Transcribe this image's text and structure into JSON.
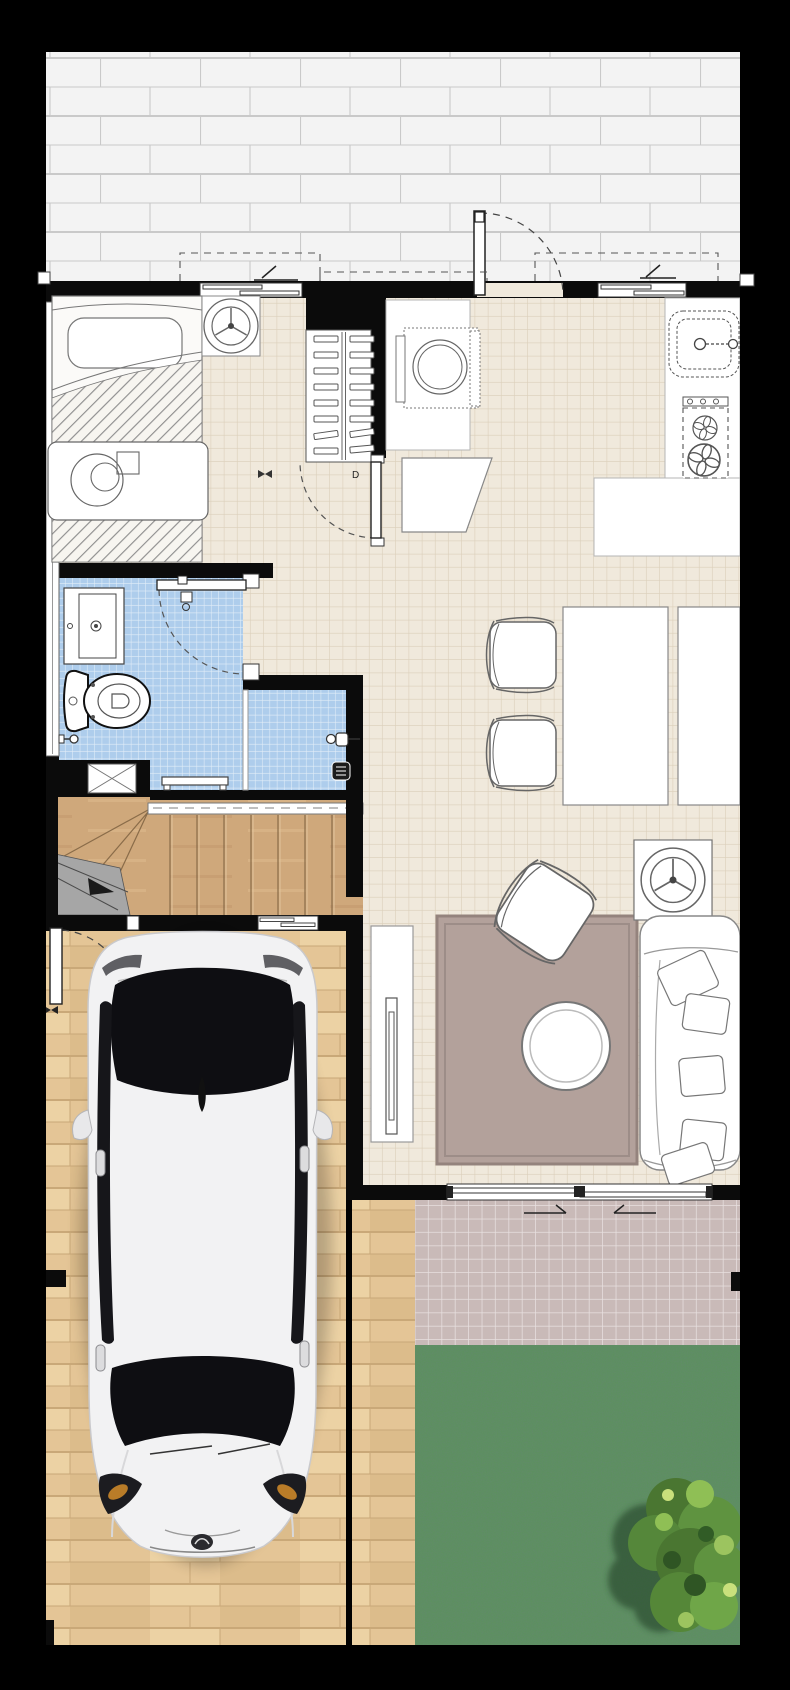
{
  "meta": {
    "image_type": "architectural floor plan, top-down 2D render, ground floor of a narrow townhouse",
    "canvas_px": "790x1690",
    "orientation": "street/patio at top, garden at bottom"
  },
  "labels": {
    "door_marker": "D"
  },
  "palette": {
    "background": "#000000",
    "wall": "#0b0b0b",
    "patio_brick": "#f3f3f3",
    "brick_line": "#c9c9c9",
    "interior_tile": "#f0e9dc",
    "interior_tile_line": "#dbcfba",
    "bathroom_tile": "#aecdec",
    "stair_wood": "#cfa87b",
    "garage_wood": "#e4c596",
    "landing_gray": "#a6a6a6",
    "rug": "#b3a19b",
    "terrace_tile": "#c9bab8",
    "lawn": "#5d9060",
    "tree_dark": "#3f6b2f",
    "tree_mid": "#5f9340",
    "tree_light": "#8fbf55",
    "car_body": "#f2f2f3",
    "car_glass": "#121216",
    "fixture_white": "#ffffff",
    "outline": "#555555"
  },
  "rooms": [
    {
      "name": "front-patio",
      "floor": "gray brick pavers, running bond"
    },
    {
      "name": "bedroom",
      "floor": "beige ceramic tile",
      "furniture": [
        "single bed with hatched blanket",
        "pillow",
        "headboard",
        "overbed table with round lamp and box",
        "table fan on corner stand"
      ]
    },
    {
      "name": "wardrobe-closet",
      "furniture": [
        "double clothes rail with 8 pairs of hangers"
      ]
    },
    {
      "name": "kitchen",
      "floor": "beige ceramic tile",
      "furniture": [
        "washing machine with round drum",
        "counter along left wall",
        "work table (trapezoid)",
        "kitchen sink with faucet",
        "two-burner hob with 3 knobs",
        "L-shaped counter"
      ]
    },
    {
      "name": "dining-area",
      "floor": "beige ceramic tile",
      "furniture": [
        "dining table",
        "wall bench",
        "two upholstered chairs"
      ]
    },
    {
      "name": "bathroom",
      "floor": "light blue mosaic tile",
      "furniture": [
        "vanity sink",
        "toilet",
        "wet-area bench",
        "shower mixer",
        "floor drain",
        "glass shower partition",
        "towel hook"
      ]
    },
    {
      "name": "staircase",
      "floor": "oak wood",
      "furniture": [
        "straight treads",
        "winder steps",
        "gray landing",
        "handrail"
      ]
    },
    {
      "name": "living-room",
      "floor": "beige ceramic tile",
      "furniture": [
        "mauve area rug",
        "rotated armchair",
        "round coffee table",
        "fan on square side table",
        "sofa with five cushions against right wall",
        "TV sideboard",
        "flat TV"
      ]
    },
    {
      "name": "garage-driveway",
      "floor": "light oak planks",
      "furniture": [
        "white sedan car seen from above, nose toward garden"
      ]
    },
    {
      "name": "terrace",
      "floor": "mauve tile with white joints"
    },
    {
      "name": "garden",
      "floor": "lawn grass",
      "furniture": [
        "large shrub with shadow, bottom-right corner"
      ]
    }
  ],
  "openings": [
    {
      "name": "main-entrance-door",
      "type": "swing door, open 90° onto patio",
      "location": "top wall, centre"
    },
    {
      "name": "bedroom-street-window",
      "type": "sliding window",
      "location": "top wall, left"
    },
    {
      "name": "kitchen-street-window",
      "type": "sliding window",
      "location": "top wall, right"
    },
    {
      "name": "left-facade-window",
      "type": "narrow strip window",
      "location": "left wall, bedroom + bathroom"
    },
    {
      "name": "hall-to-kitchen-door",
      "type": "swing door with D marker",
      "location": "wall right of wardrobe"
    },
    {
      "name": "bathroom-door",
      "type": "swing door, shown folded open",
      "location": "bathroom top-right"
    },
    {
      "name": "garage-side-door",
      "type": "swing door, opens into garage",
      "location": "left wall under stairs"
    },
    {
      "name": "garage-back-window",
      "type": "small sliding window",
      "location": "garage top wall"
    },
    {
      "name": "terrace-sliding-door",
      "type": "double sliding glass door with direction arrows",
      "location": "living-room bottom wall"
    }
  ]
}
